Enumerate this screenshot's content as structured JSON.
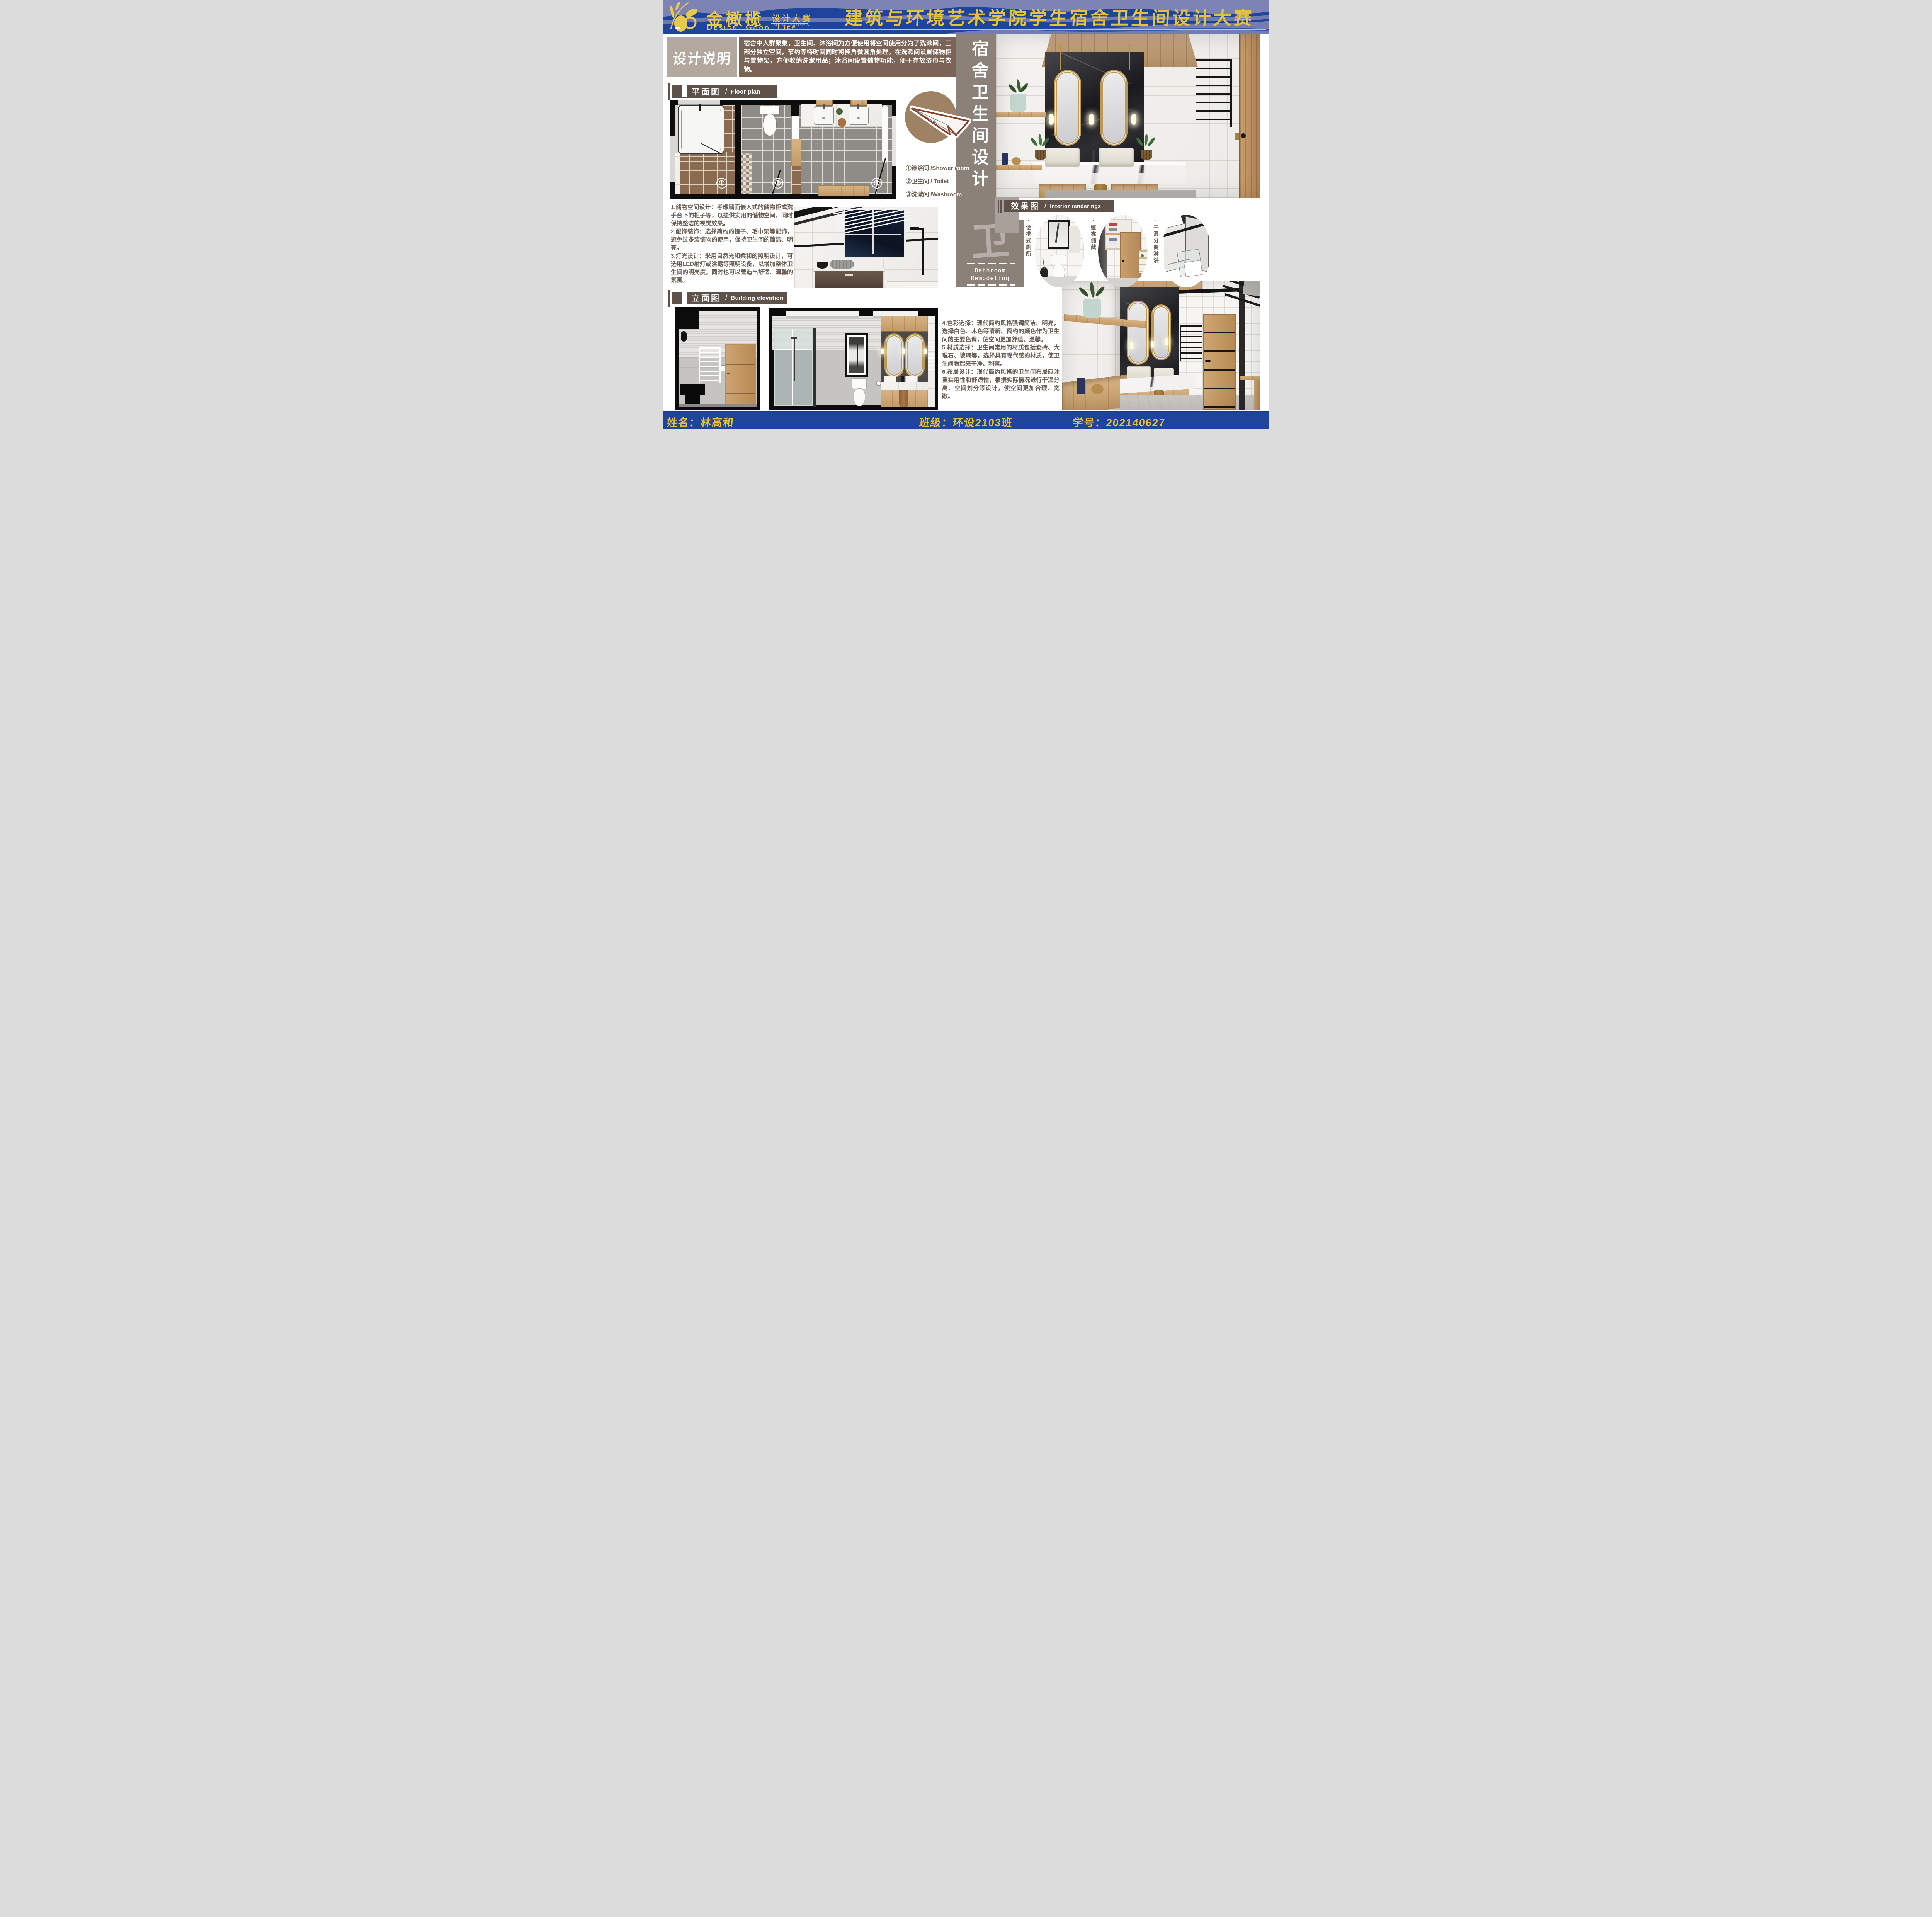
{
  "header": {
    "brand": {
      "name": "金橄榄",
      "dot": "·",
      "competition": "设计大赛",
      "competition_en": "DESIGN COMPETITION",
      "slogan": "Design. Good. Life"
    },
    "title": "建筑与环境艺术学院学生宿舍卫生间设计大赛"
  },
  "design_note": {
    "label": "设计说明",
    "body": "宿舍中人群聚集，卫生间、沐浴间为方便使用将空间使用分为了洗漱间，三部分独立空间，节约等待时间同时将棱角做圆角处理。在洗漱间设置储物柜与置物架，方便收纳洗漱用品；沐浴间设置储物功能，便于存放浴巾与衣物。"
  },
  "sections": {
    "floor_plan": {
      "zh": "平面图",
      "sep": "/",
      "en": "Floor plan"
    },
    "elevation": {
      "zh": "立面图",
      "sep": "/",
      "en": "Building elevation"
    },
    "renderings": {
      "zh": "效果图",
      "sep": "/",
      "en": "Interior renderings"
    }
  },
  "floor_plan": {
    "room_numbers": [
      "①",
      "②",
      "③"
    ]
  },
  "legend": {
    "items": [
      "①淋浴间 /Shower room",
      "②卫生间 / Toilet",
      "③洗漱间 /Washroom"
    ]
  },
  "notes": {
    "left": [
      "1.储物空间设计：考虑墙面嵌入式的储物柜或洗手台下的柜子等，以提供实用的储物空间，同时保持整洁的视觉效果。",
      "2.配饰装饰：选择简约的镜子、毛巾架等配饰，避免过多装饰物的使用，保持卫生间的简洁、明亮。",
      "3.灯光设计：采用自然光和柔和的照明设计，可选用LED射灯或浴霸等照明设备，以增加整体卫生间的明亮度，同时也可以营造出舒适、温馨的氛围。"
    ],
    "right": [
      "4.色彩选择：现代简约风格强调简洁、明亮，选择白色、木色等清新、简约的颜色作为卫生间的主要色调，使空间更加舒适、温馨。",
      "5.材质选择：卫生间常用的材质包括瓷砖、大理石、玻璃等，选择具有现代感的材质，使卫生间看起来干净、利落。",
      "6.布局设计：现代简约风格的卫生间布局应注重实用性和舒适性，根据实际情况进行干湿分离、空间划分等设计，使空间更加合理、宽敞。"
    ]
  },
  "side_banner": {
    "vertical_title": "宿舍卫生间设计",
    "big_char": "卫",
    "en_line1": "Bathroom",
    "en_line2": "Remodeling"
  },
  "thumbs": [
    {
      "label": "·便携式厕所"
    },
    {
      "label": "·壁龛储藏"
    },
    {
      "label": "·干湿分离淋浴"
    }
  ],
  "footer": {
    "name": "姓名：林高和",
    "class": "班级：环设2103班",
    "student_id": "学号：202140627"
  },
  "colors": {
    "header_blue": "#1e449b",
    "wave": "#7e83b5",
    "gold": "#e9c84f",
    "title_gold": "#e6c23c",
    "note_label_bg": "#b3a89e",
    "note_body_bg": "#7b6456",
    "section_bar": "#5d5149",
    "strip_gray": "#8b8179",
    "big_char_gray": "#b6afa9",
    "text_brown": "#6b5d52",
    "plane_red": "#8e3b24",
    "plane_circle": "#9f8164",
    "footer_gold": "#e7c12e",
    "plan_brown": "#8a6b4f",
    "wood_main": "#c9a06d"
  }
}
